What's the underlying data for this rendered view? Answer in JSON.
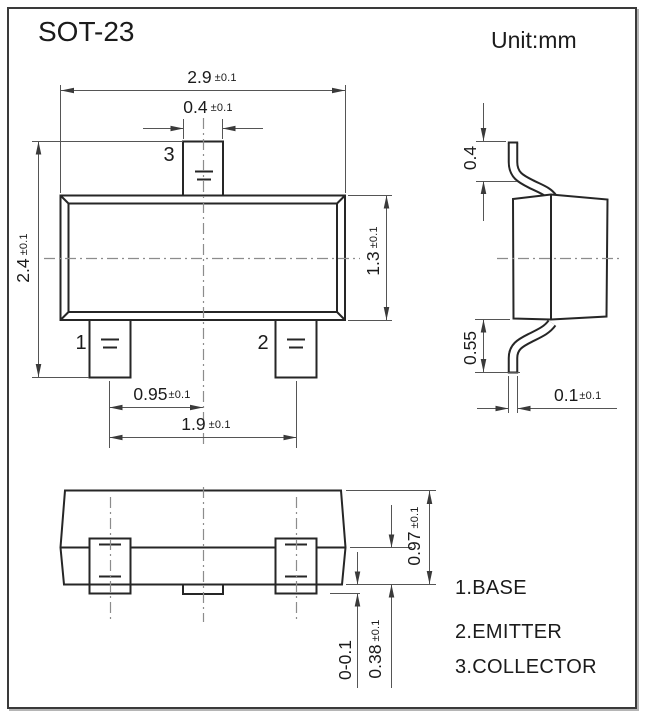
{
  "title": "SOT-23",
  "unit": "Unit:mm",
  "pins": {
    "p1": "1",
    "p2": "2",
    "p3": "3"
  },
  "legend": {
    "items": [
      "1.BASE",
      "2.EMITTER",
      "3.COLLECTOR"
    ]
  },
  "dims": {
    "body_width": {
      "v": "2.9",
      "t": "±0.1"
    },
    "tab_width": {
      "v": "0.4",
      "t": "±0.1"
    },
    "overall_length": {
      "v": "2.4",
      "t": "±0.1"
    },
    "body_length": {
      "v": "1.3",
      "t": "±0.1"
    },
    "lead_offset": {
      "v": "0.95",
      "t": "±0.1"
    },
    "lead_span": {
      "v": "1.9",
      "t": "±0.1"
    },
    "top_lead_height": {
      "v": "0.4"
    },
    "bottom_lead_height": {
      "v": "0.55"
    },
    "lead_thickness": {
      "v": "0.1",
      "t": "±0.1"
    },
    "body_height": {
      "v": "0.97",
      "t": "±0.1"
    },
    "standoff": {
      "v": "0-0.1"
    },
    "shoulder_height": {
      "v": "0.38",
      "t": "±0.1"
    }
  },
  "colors": {
    "line": "#262626",
    "dim": "#555555",
    "centerline": "#8c8c8c",
    "frame": "#3a3a3a"
  }
}
